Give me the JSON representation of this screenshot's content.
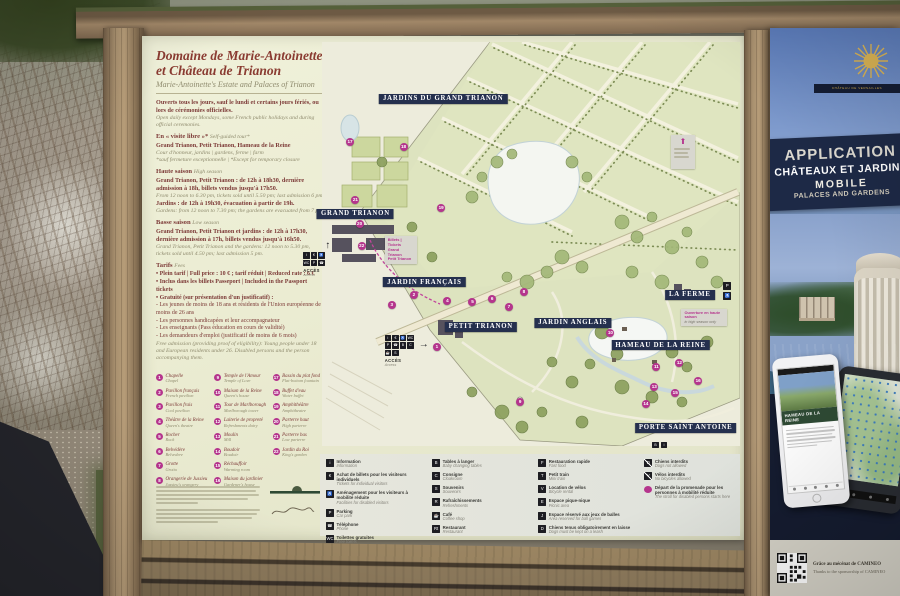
{
  "colors": {
    "accent_pink": "#b5358d",
    "band_navy": "#25304e",
    "title_maroon": "#8a3b31",
    "gold": "#c9a84e"
  },
  "sign": {
    "title1": "Domaine de Marie-Antoinette",
    "title2": "et Château de Trianon",
    "subtitle": "Marie-Antoinette's Estate and Palaces of Trianon",
    "open_fr": "Ouverts tous les jours, sauf le lundi et certains jours fériés, ou lors de cérémonies officielles.",
    "open_en": "Open daily except Mondays, some French public holidays and during official ceremonies.",
    "visite": {
      "fr": "En « visite libre »*",
      "en": "Self-guided tour*",
      "line1": "Grand Trianon, Petit Trianon, Hameau de la Reine",
      "line2": "Cour d'honneur, jardins | gardens, ferme | farm",
      "note": "*sauf fermeture exceptionnelle | *Except for temporary closure"
    },
    "haute": {
      "fr": "Haute saison",
      "en": "High season",
      "fr1": "Grand Trianon, Petit Trianon : de 12h à 18h30, dernière admission à 18h, billets vendus jusqu'à 17h50.",
      "en1": "From 12 noon to 6.30 pm, tickets sold until 5.50 pm; last admission 6 pm.",
      "fr2": "Jardins : de 12h à 19h30, évacuation à partir de 19h.",
      "en2": "Gardens: from 12 noon to 7.30 pm; the gardens are evacuated from 7 pm."
    },
    "basse": {
      "fr": "Basse saison",
      "en": "Low season",
      "fr1": "Grand Trianon, Petit Trianon et jardins : de 12h à 17h30, dernière admission à 17h, billets vendus jusqu'à 16h50.",
      "en1": "Grand Trianon, Petit Trianon and the gardens: 12 noon to 5.30 pm, tickets sold until 4.50 pm; last admission 5 pm."
    },
    "tarifs": {
      "fr": "Tarifs",
      "en": "Fees",
      "bullets": [
        "Plein tarif | Full price : 10 € ; tarif réduit | Reduced rate : 6 €",
        "Inclus dans les billets Passeport | Included in the Passport tickets",
        "Gratuité (sur présentation d'un justificatif) :"
      ],
      "free_items": [
        "Les jeunes de moins de 18 ans et résidents de l'Union européenne de moins de 26 ans",
        "Les personnes handicapées et leur accompagnateur",
        "Les enseignants (Pass éducation en cours de validité)",
        "Les demandeurs d'emploi (justificatif de moins de 6 mois)"
      ],
      "free_en": "Free admission (providing proof of eligibility): Young people under 18 and European residents under 26. Disabled persons and the person accompanying them."
    },
    "landmarks_col1": [
      {
        "n": "1",
        "fr": "Chapelle",
        "en": "Chapel"
      },
      {
        "n": "2",
        "fr": "Pavillon français",
        "en": "French pavilion"
      },
      {
        "n": "3",
        "fr": "Pavillon frais",
        "en": "Cool pavilion"
      },
      {
        "n": "4",
        "fr": "Théâtre de la Reine",
        "en": "Queen's theatre"
      },
      {
        "n": "5",
        "fr": "Rocher",
        "en": "Rock"
      },
      {
        "n": "6",
        "fr": "Belvédère",
        "en": "Belvedere"
      },
      {
        "n": "7",
        "fr": "Grotte",
        "en": "Grotto"
      },
      {
        "n": "8",
        "fr": "Orangerie de Jussieu",
        "en": "Jussieu's orangery"
      }
    ],
    "landmarks_col2": [
      {
        "n": "9",
        "fr": "Temple de l'Amour",
        "en": "Temple of Love"
      },
      {
        "n": "10",
        "fr": "Maison de la Reine",
        "en": "Queen's house"
      },
      {
        "n": "11",
        "fr": "Tour de Marlborough",
        "en": "Marlborough tower"
      },
      {
        "n": "12",
        "fr": "Laiterie de propreté",
        "en": "Refreshments dairy"
      },
      {
        "n": "13",
        "fr": "Moulin",
        "en": "Mill"
      },
      {
        "n": "14",
        "fr": "Boudoir",
        "en": "Boudoir"
      },
      {
        "n": "15",
        "fr": "Réchauffoir",
        "en": "Warming room"
      },
      {
        "n": "16",
        "fr": "Maison du jardinier",
        "en": "Gardener's house"
      }
    ],
    "landmarks_col3": [
      {
        "n": "17",
        "fr": "Bassin du plat fond",
        "en": "Flat-bottom fountain"
      },
      {
        "n": "18",
        "fr": "Buffet d'eau",
        "en": "Water buffet"
      },
      {
        "n": "19",
        "fr": "Amphithéâtre",
        "en": "Amphitheatre"
      },
      {
        "n": "20",
        "fr": "Parterre haut",
        "en": "High parterre"
      },
      {
        "n": "21",
        "fr": "Parterre bas",
        "en": "Low parterre"
      },
      {
        "n": "22",
        "fr": "Jardin du Roi",
        "en": "King's garden"
      }
    ]
  },
  "map": {
    "labels": [
      {
        "text": "JARDINS DU GRAND TRIANON",
        "x": 29,
        "y": 14
      },
      {
        "text": "GRAND TRIANON",
        "x": 8,
        "y": 42.5
      },
      {
        "text": "JARDIN FRANÇAIS",
        "x": 24.5,
        "y": 59.5
      },
      {
        "text": "PETIT TRIANON",
        "x": 38,
        "y": 70.5
      },
      {
        "text": "JARDIN ANGLAIS",
        "x": 60,
        "y": 69.5
      },
      {
        "text": "LA FERME",
        "x": 88,
        "y": 62.5
      },
      {
        "text": "HAMEAU DE LA REINE",
        "x": 81,
        "y": 75
      },
      {
        "text": "PORTE SAINT ANTOINE",
        "x": 87,
        "y": 95.5
      }
    ],
    "markers": [
      {
        "n": "1",
        "x": 27.5,
        "y": 75.5
      },
      {
        "n": "2",
        "x": 22,
        "y": 62.6
      },
      {
        "n": "3",
        "x": 16.7,
        "y": 65
      },
      {
        "n": "4",
        "x": 30,
        "y": 64
      },
      {
        "n": "5",
        "x": 36,
        "y": 64.4
      },
      {
        "n": "6",
        "x": 40.7,
        "y": 63.6
      },
      {
        "n": "7",
        "x": 44.7,
        "y": 65.6
      },
      {
        "n": "8",
        "x": 48.3,
        "y": 62
      },
      {
        "n": "9",
        "x": 47.4,
        "y": 89
      },
      {
        "n": "10",
        "x": 69,
        "y": 72
      },
      {
        "n": "11",
        "x": 80,
        "y": 80.5
      },
      {
        "n": "12",
        "x": 85.5,
        "y": 79.5
      },
      {
        "n": "13",
        "x": 79.5,
        "y": 85.5
      },
      {
        "n": "14",
        "x": 77.5,
        "y": 89.5
      },
      {
        "n": "15",
        "x": 84.5,
        "y": 87
      },
      {
        "n": "16",
        "x": 90,
        "y": 84
      },
      {
        "n": "17",
        "x": 6.7,
        "y": 24.8
      },
      {
        "n": "18",
        "x": 19.5,
        "y": 26
      },
      {
        "n": "19",
        "x": 28.5,
        "y": 41
      },
      {
        "n": "20",
        "x": 9,
        "y": 45
      },
      {
        "n": "21",
        "x": 8,
        "y": 39
      },
      {
        "n": "22",
        "x": 9.5,
        "y": 50.5
      }
    ],
    "access_label": "Accès",
    "access_sub": "Access",
    "ticket_note": {
      "l1": "Billets | Tickets",
      "l2": "Grand Trianon",
      "l3": "Petit Trianon"
    },
    "season_note": {
      "l1": "Ouverture en haute saison",
      "l2": "in high season only"
    }
  },
  "legend": {
    "col1": [
      {
        "g": "i",
        "fr": "Information",
        "en": "Information"
      },
      {
        "g": "€",
        "fr": "Achat de billets pour les visiteurs individuels",
        "en": "Tickets for individual visitors"
      },
      {
        "g": "♿",
        "fr": "Aménagement pour les visiteurs à mobilité réduite",
        "en": "Facilities for disabled visitors"
      },
      {
        "g": "P",
        "fr": "Parking",
        "en": "Car park"
      },
      {
        "g": "☎",
        "fr": "Téléphone",
        "en": "Phone"
      },
      {
        "g": "WC",
        "fr": "Toilettes gratuites",
        "en": "Free toilets"
      }
    ],
    "col2": [
      {
        "g": "B",
        "fr": "Tables à langer",
        "en": "Baby changing tables"
      },
      {
        "g": "C",
        "fr": "Consigne",
        "en": "Cloakroom"
      },
      {
        "g": "S",
        "fr": "Souvenirs",
        "en": "Souvenirs"
      },
      {
        "g": "R",
        "fr": "Rafraîchissements",
        "en": "Refreshments"
      },
      {
        "g": "☕",
        "fr": "Café",
        "en": "Coffee shop"
      },
      {
        "g": "Rt",
        "fr": "Restaurant",
        "en": "Restaurant"
      }
    ],
    "col3": [
      {
        "g": "F",
        "fr": "Restauration rapide",
        "en": "Fast food"
      },
      {
        "g": "T",
        "fr": "Petit train",
        "en": "Mini train"
      },
      {
        "g": "V",
        "fr": "Location de vélos",
        "en": "Bicycle rental"
      },
      {
        "g": "E",
        "fr": "Espace pique-nique",
        "en": "Picnic area"
      },
      {
        "g": "J",
        "fr": "Espace réservé aux jeux de balles",
        "en": "Area reserved for ball games"
      },
      {
        "g": "D",
        "fr": "Chiens tenus obligatoirement en laisse",
        "en": "Dogs must be kept on a leash"
      }
    ],
    "col4": [
      {
        "fr": "Chiens interdits",
        "en": "Dogs not allowed"
      },
      {
        "fr": "Vélos interdits",
        "en": "No bicycles allowed"
      },
      {
        "fr": "Départ de la promenade pour les personnes à mobilité réduite",
        "en": "The stroll for disabled persons starts here"
      }
    ]
  },
  "panel": {
    "emblem_caption": "CHÂTEAU DE VERSAILLES",
    "title_lines": [
      "APPLICATION",
      "CHÂTEAUX ET JARDINS",
      "MOBILE",
      "PALACES AND GARDENS"
    ],
    "phone_app_title": "HAMEAU DE LA REINE",
    "sponsor_fr": "Grâce au mécénat de CAMINEO",
    "sponsor_en": "Thanks to the sponsorship of CAMINEO"
  }
}
